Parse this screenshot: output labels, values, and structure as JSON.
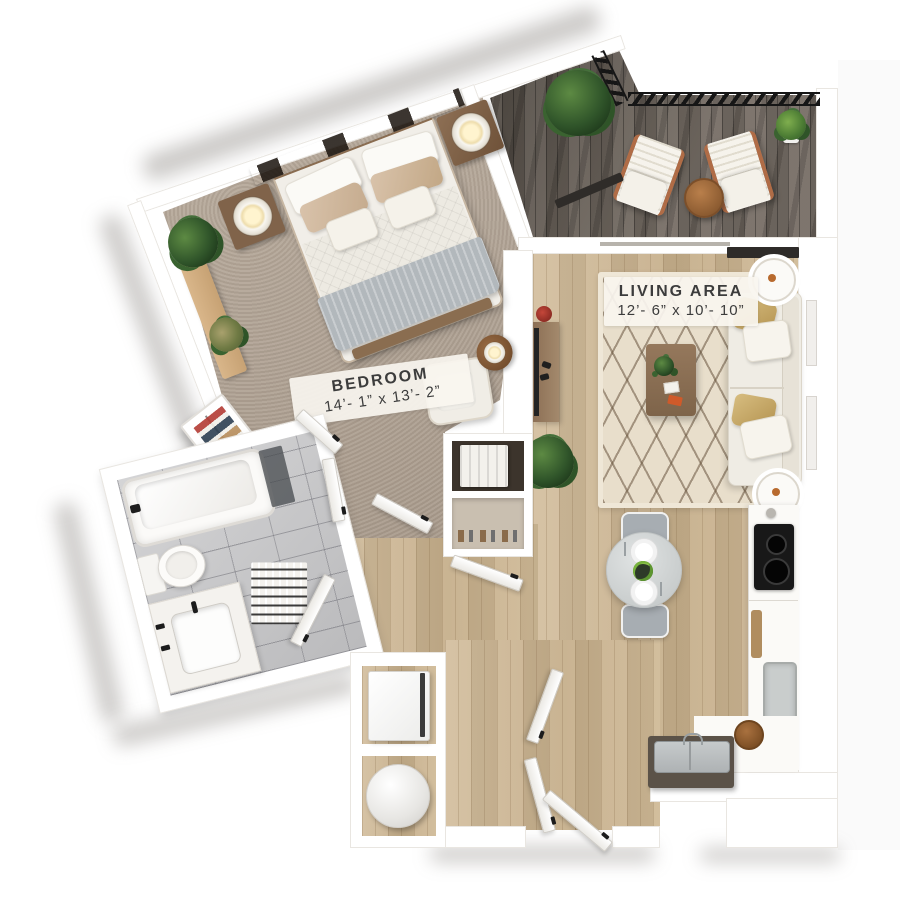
{
  "rooms": {
    "bedroom": {
      "label": "BEDROOM",
      "dimensions": "14’- 1” x 13’- 2”",
      "floor": "carpet"
    },
    "living_area": {
      "label": "LIVING AREA",
      "dimensions": "12’- 6” x 10’- 10”",
      "floor": "hardwood"
    },
    "kitchen": {
      "floor": "hardwood"
    },
    "bathroom": {
      "floor": "tile"
    },
    "balcony": {
      "floor": "dark-deck"
    },
    "entry_hall": {
      "floor": "hardwood"
    },
    "closet": {
      "floor": "hardwood"
    }
  },
  "palette": {
    "background": "#ffffff",
    "wall": "#ffffff",
    "wall_edge": "#e9e6e1",
    "carpet": "#b3a494",
    "hardwood": "#cdb795",
    "deck": "#6e655c",
    "tile": "#c6c6c8",
    "rug": "#e8decb",
    "sofa": "#efece4",
    "accent_gold": "#c4a86b",
    "wood_furniture": "#8a6c50",
    "plant_green": "#3f6b31",
    "railing": "#1a1a1a",
    "island": "#5b5248",
    "cooktop": "#181818"
  },
  "furniture": {
    "bedroom": [
      "bed",
      "headboard-shelf",
      "nightstand-left",
      "nightstand-right",
      "table-lamp-left",
      "table-lamp-right",
      "plant-console",
      "armchair",
      "side-table"
    ],
    "living_area": [
      "sofa",
      "area-rug",
      "coffee-table",
      "round-side-table-top",
      "round-side-table-bottom",
      "tv-console",
      "floor-plant"
    ],
    "kitchen": [
      "counter",
      "cooktop",
      "cutting-board",
      "basin-sink",
      "island-sink",
      "corner-counter",
      "dining-table",
      "dining-chair-top",
      "dining-chair-bottom"
    ],
    "bathroom": [
      "bathtub",
      "toilet",
      "vanity-sink",
      "bath-mat"
    ],
    "balcony": [
      "lounge-chair-left",
      "lounge-chair-right",
      "bistro-table",
      "large-plant",
      "potted-plant",
      "railing"
    ],
    "entry_hall": [
      "wardrobe-closet",
      "linen-closet",
      "storage-closet",
      "washer",
      "water-heater",
      "entry-doors"
    ]
  }
}
